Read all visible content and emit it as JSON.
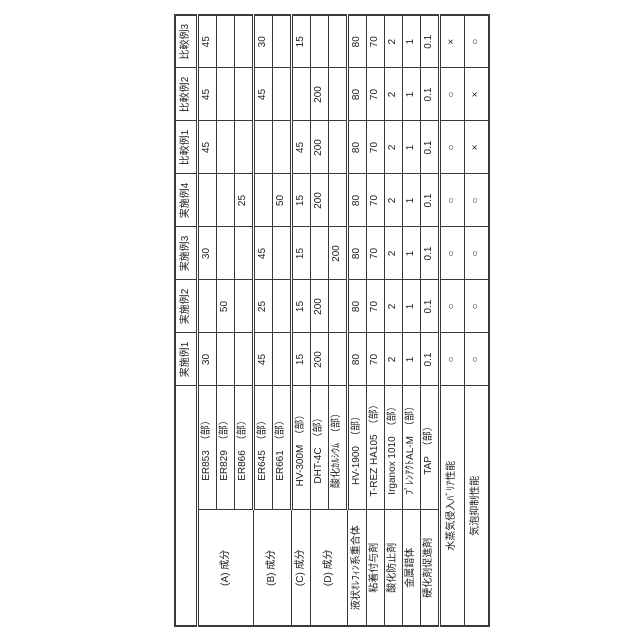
{
  "table": {
    "corner_label": "",
    "columns": [
      "実施例1",
      "実施例2",
      "実施例3",
      "実施例4",
      "比較例1",
      "比較例2",
      "比較例3"
    ],
    "rows": [
      {
        "group": "(A) 成分",
        "group_span": 3,
        "item": "ER853　（部）",
        "values": [
          "30",
          "",
          "30",
          "",
          "45",
          "45",
          "45"
        ]
      },
      {
        "item": "ER829　（部）",
        "values": [
          "",
          "50",
          "",
          "",
          "",
          "",
          ""
        ]
      },
      {
        "item": "ER866　（部）",
        "values": [
          "",
          "",
          "",
          "25",
          "",
          "",
          ""
        ]
      },
      {
        "group": "(B) 成分",
        "group_span": 2,
        "item": "ER645　（部）",
        "values": [
          "45",
          "25",
          "45",
          "",
          "",
          "45",
          "30"
        ]
      },
      {
        "item": "ER661　（部）",
        "values": [
          "",
          "",
          "",
          "50",
          "",
          "",
          ""
        ]
      },
      {
        "group": "(C) 成分",
        "group_span": 1,
        "item": "HV-300M　（部）",
        "values": [
          "15",
          "15",
          "15",
          "15",
          "45",
          "",
          "15"
        ]
      },
      {
        "group": "(D) 成分",
        "group_span": 2,
        "item": "DHT-4C　（部）",
        "values": [
          "200",
          "200",
          "",
          "200",
          "200",
          "200",
          ""
        ]
      },
      {
        "item": "酸化ｶﾙｼｳﾑ　（部）",
        "values": [
          "",
          "",
          "200",
          "",
          "",
          "",
          ""
        ]
      },
      {
        "group": "液状ｵﾚﾌｨﾝ系重合体",
        "group_span": 1,
        "item": "HV-1900　（部）",
        "values": [
          "80",
          "80",
          "80",
          "80",
          "80",
          "80",
          "80"
        ]
      },
      {
        "group": "粘着付与剤",
        "group_span": 1,
        "item": "T-REZ HA105　（部）",
        "values": [
          "70",
          "70",
          "70",
          "70",
          "70",
          "70",
          "70"
        ]
      },
      {
        "group": "酸化防止剤",
        "group_span": 1,
        "item": "Irganox 1010　（部）",
        "values": [
          "2",
          "2",
          "2",
          "2",
          "2",
          "2",
          "2"
        ]
      },
      {
        "group": "金属錯体",
        "group_span": 1,
        "item": "ﾌﾟﾚﾝｱｸﾄAL-M　（部）",
        "values": [
          "1",
          "1",
          "1",
          "1",
          "1",
          "1",
          "1"
        ]
      },
      {
        "group": "硬化剤促進剤",
        "group_span": 1,
        "item": "TAP　（部）",
        "values": [
          "0.1",
          "0.1",
          "0.1",
          "0.1",
          "0.1",
          "0.1",
          "0.1"
        ]
      },
      {
        "label": "水蒸気侵入ﾊﾞﾘｱ性能",
        "values": [
          "○",
          "○",
          "○",
          "○",
          "○",
          "○",
          "×"
        ]
      },
      {
        "label": "気泡抑制性能",
        "values": [
          "○",
          "○",
          "○",
          "○",
          "×",
          "×",
          "○"
        ]
      }
    ]
  }
}
